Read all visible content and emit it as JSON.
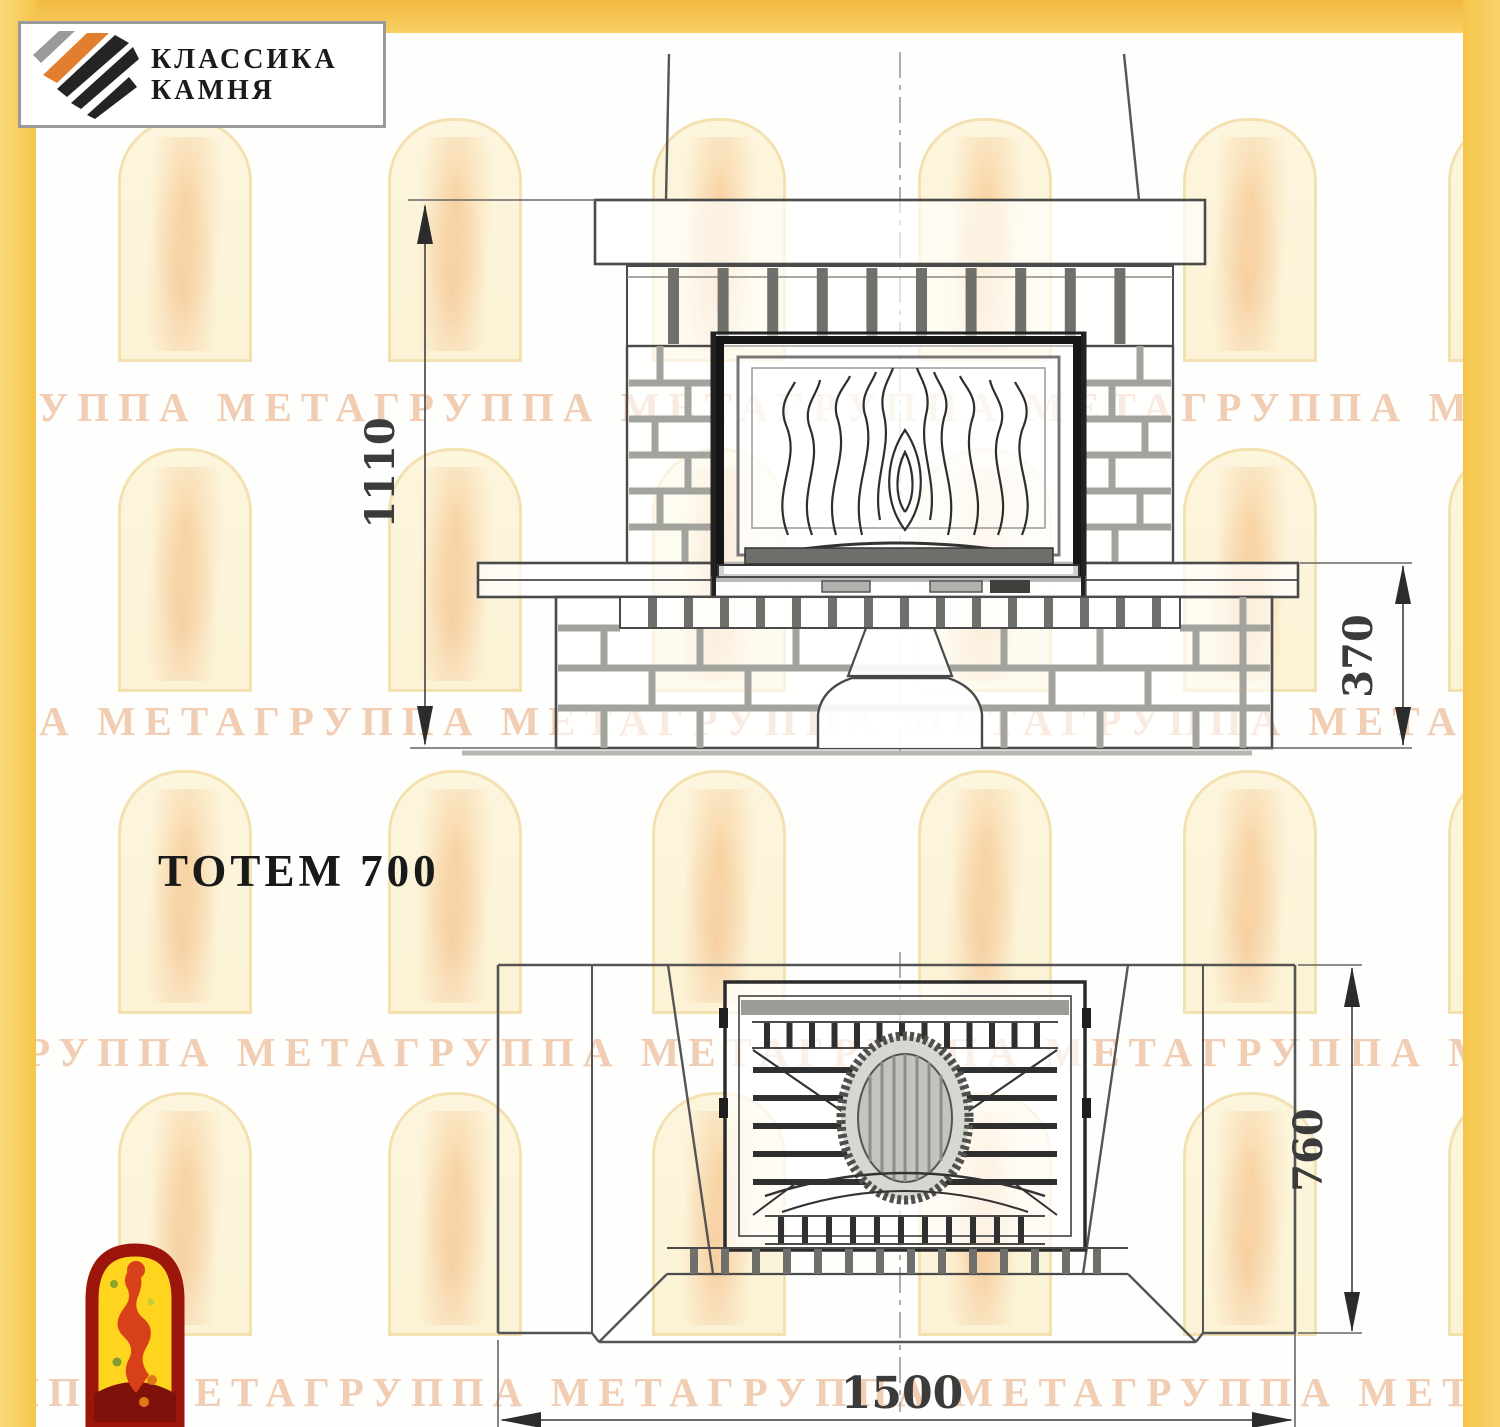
{
  "brand": {
    "name_line1": "КЛАССИКА",
    "name_line2": "КАМНЯ"
  },
  "watermark": {
    "text": "ГРУППА МЕТАГРУППА МЕТАГРУППА МЕТАГРУППА МЕТА"
  },
  "drawing": {
    "title": "ТОТЕМ 700",
    "dimensions": {
      "front_total_height": "1110",
      "front_base_height": "370",
      "plan_depth": "760",
      "plan_width": "1500"
    }
  },
  "colors": {
    "frame_yellow": "#F7CB57",
    "drawing_line": "#4a4a4a",
    "watermark_text": "#ECC0A0",
    "logo_red": "#9C150A",
    "logo_yellow": "#FFD41E",
    "logo_orange": "#E27F2E"
  }
}
